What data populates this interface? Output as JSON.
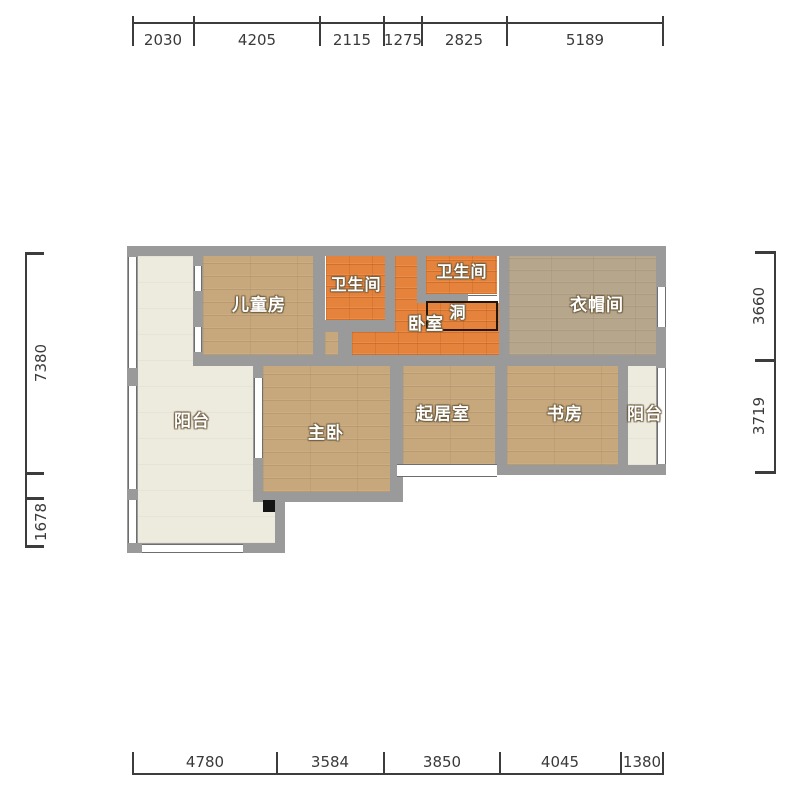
{
  "plan_type": "apartment-floor-plan",
  "rooms": {
    "children": {
      "label": "儿童房"
    },
    "bath1": {
      "label": "卫生间"
    },
    "bath2": {
      "label": "卫生间"
    },
    "bedroom": {
      "label": "卧室"
    },
    "hole": {
      "label": "洞"
    },
    "cloakroom": {
      "label": "衣帽间"
    },
    "balcony_left": {
      "label": "阳台"
    },
    "master": {
      "label": "主卧"
    },
    "living": {
      "label": "起居室"
    },
    "study": {
      "label": "书房"
    },
    "balcony_right": {
      "label": "阳台"
    }
  },
  "dimensions": {
    "top": [
      "2030",
      "4205",
      "2115",
      "1275",
      "2825",
      "5189"
    ],
    "bottom": [
      "4780",
      "3584",
      "3850",
      "4045",
      "1380"
    ],
    "left": [
      "7380",
      "1678"
    ],
    "right": [
      "3660",
      "3719"
    ]
  },
  "colors": {
    "wall": "#9a9a9a",
    "wood_floor": "#c7a87d",
    "cloak_floor": "#b6a68b",
    "tile_floor": "#e5833c",
    "balcony_floor": "#edeade",
    "dimension_text": "#3a3a3a",
    "label_text": "#ffffff",
    "hole_border": "#241505"
  }
}
